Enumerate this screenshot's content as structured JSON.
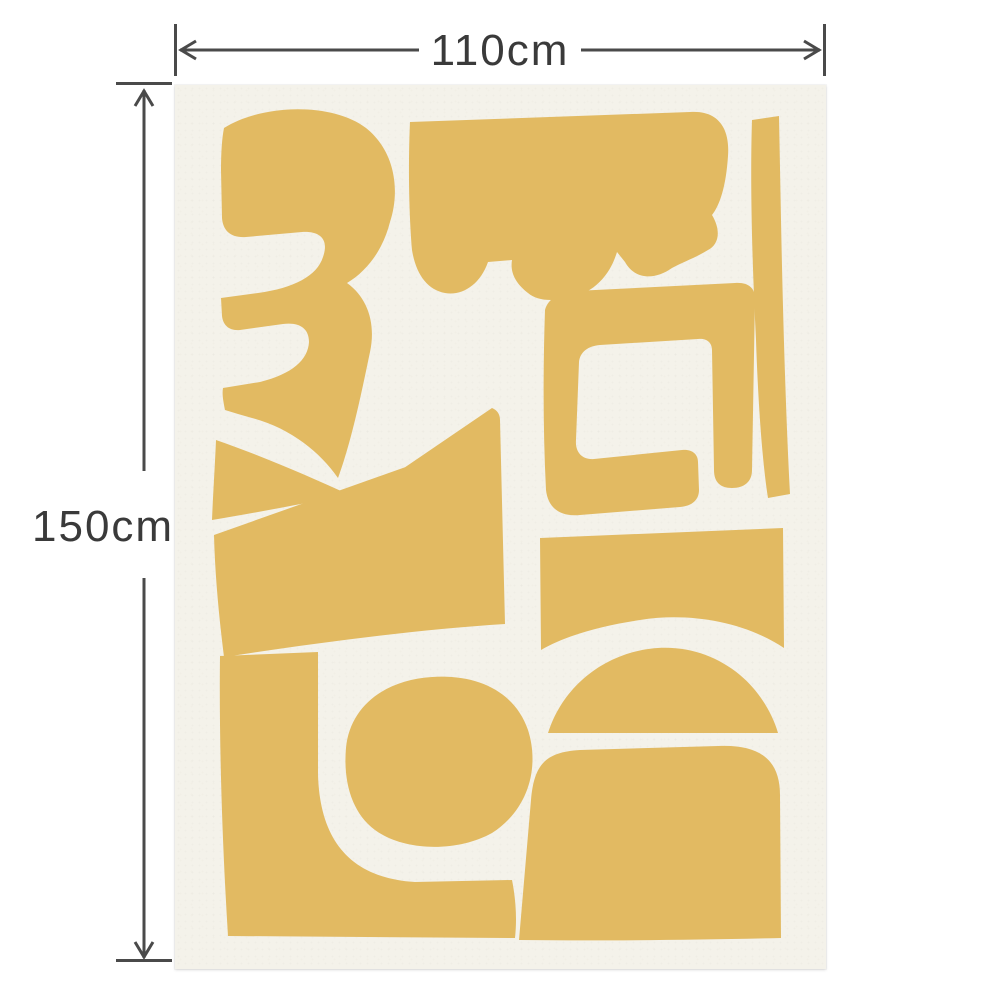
{
  "dimensions": {
    "width_label": "110cm",
    "height_label": "150cm"
  },
  "colors": {
    "page_background": "#ffffff",
    "poster_background": "#f4f2ea",
    "shape_fill": "#e2ba62",
    "dimension_line": "#4a4a4a",
    "dimension_text": "#3a3a3a"
  },
  "poster": {
    "viewbox": "0 0 651 884",
    "shapes": [
      {
        "name": "reversed-three-cutout",
        "path": "M 49 43 C 87 19 157 17 191 43 C 221 67 225 107 215 137 C 208 165 192 186 172 198 C 193 213 201 239 195 267 C 187 305 177 355 163 393 C 145 367 115 343 77 333 L 63 329 L 50 325 C 48 315 47 309 48 303 L 85 297 C 117 289 133 275 134 257 C 134 243 124 237 108 239 L 65 245 C 54 246 48 240 47 231 L 46 213 L 83 208 C 119 203 142 191 148 172 C 154 155 146 146 127 147 L 71 152 C 56 153 48 146 47 133 L 46 85 C 46 67 47 53 49 43 Z"
      },
      {
        "name": "cloud-scallop-cutout",
        "path": "M 235 37 L 515 27 C 543 25 555 43 553 71 C 551 101 545 120 537 130 C 547 147 543 160 533 165 C 520 173 508 177 497 183 C 480 195 460 195 450 177 L 442 167 C 435 190 420 207 395 213 C 375 217 361 215 353 208 C 340 198 335 187 337 175 L 313 177 C 305 200 287 211 270 208 C 253 205 241 190 237 165 C 234 130 233 80 235 37 Z"
      },
      {
        "name": "right-bar-cutout",
        "path": "M 577 35 C 575 95 577 175 581 255 C 583 315 587 375 593 413 L 615 409 C 611 335 608 235 606 135 L 604 31 Z"
      },
      {
        "name": "bracket-cutout",
        "path": "M 370 225 C 373 213 385 208 400 206 L 560 198 C 573 197 580 203 580 213 L 577 385 C 577 397 569 403 557 403 C 545 403 539 397 539 385 L 537 265 C 537 257 531 253 523 254 L 425 260 C 413 261 405 267 404 277 L 401 355 C 400 367 407 375 419 374 L 507 365 C 517 364 523 369 523 377 L 524 405 C 524 415 517 421 505 422 L 405 430 C 385 432 373 423 371 405 C 368 345 368 285 370 225 Z"
      },
      {
        "name": "bowtie-left-cutout",
        "path": "M 41 355 C 90 372 135 392 175 410 C 130 418 80 428 37 435 C 38 410 40 380 41 355 Z"
      },
      {
        "name": "trapezoid-bowtie-cutout",
        "path": "M 49 572 C 44 532 40 490 39 450 L 273 367 L 179 417 L 317 323 C 322 325 325 329 325 335 L 330 539 C 235 545 135 559 49 572 Z"
      },
      {
        "name": "l-shape-cutout",
        "path": "M 45 571 L 143 567 L 143 690 C 145 755 175 793 240 797 L 337 795 C 341 815 342 835 340 853 L 53 851 C 47 755 44 655 45 571 Z"
      },
      {
        "name": "pebble-cutout",
        "path": "M 171 663 C 175 621 210 595 257 592 C 303 589 340 607 353 645 C 365 683 353 725 317 748 C 283 767 230 767 200 745 C 177 728 168 697 171 663 Z"
      },
      {
        "name": "panel-cutout",
        "path": "M 365 453 L 608 443 L 609 563 C 570 537 515 527 465 535 C 425 541 390 551 366 565 Z"
      },
      {
        "name": "fin-arch-cutout",
        "path": "M 373 648 C 385 610 415 580 455 568 C 495 556 535 565 565 590 C 583 605 597 627 603 648 Z"
      },
      {
        "name": "arch-cutout",
        "path": "M 344 855 L 356 715 C 359 680 370 667 405 665 L 543 661 C 585 659 605 675 605 710 L 606 853 C 520 855 425 856 344 855 Z"
      }
    ]
  }
}
